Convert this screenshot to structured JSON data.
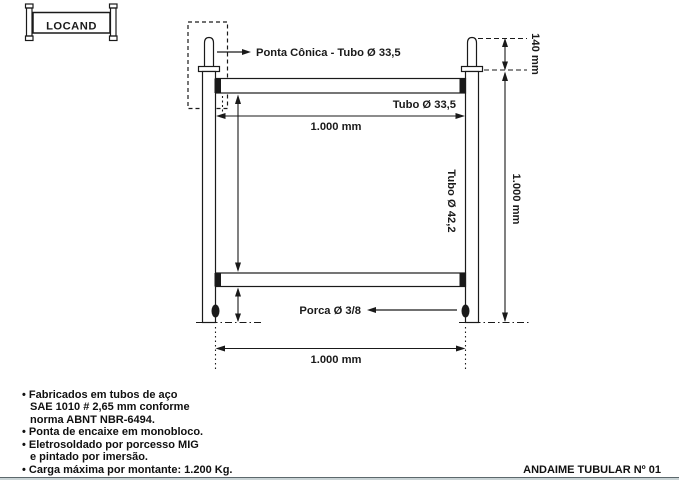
{
  "style": {
    "ink": "#1a1a1a",
    "paper": "#ffffff",
    "band": "#c9d3d5",
    "rule": "#5c686c"
  },
  "logo": {
    "text": "LOCAND"
  },
  "drawing": {
    "ponta_conica_label": "Ponta Cônica - Tubo Ø 33,5",
    "tubo_horizontal_label": "Tubo Ø 33,5",
    "top_width_dim": "1.000 mm",
    "tubo_vertical_label": "Tubo Ø 42,2",
    "height_dim": "1.000 mm",
    "tip_height_dim": "140 mm",
    "porca_label": "Porca Ø 3/8",
    "bottom_width_dim": "1.000 mm"
  },
  "notes": {
    "line1": "• Fabricados em tubos de aço",
    "line2": "SAE 1010 # 2,65 mm conforme",
    "line3": "norma ABNT NBR-6494.",
    "line4": "• Ponta de encaixe em monobloco.",
    "line5": "• Eletrosoldado por porcesso MIG",
    "line6": "e pintado por imersão.",
    "line7": "• Carga máxima por montante: 1.200 Kg."
  },
  "footer": {
    "title": "ANDAIME TUBULAR Nº 01"
  }
}
